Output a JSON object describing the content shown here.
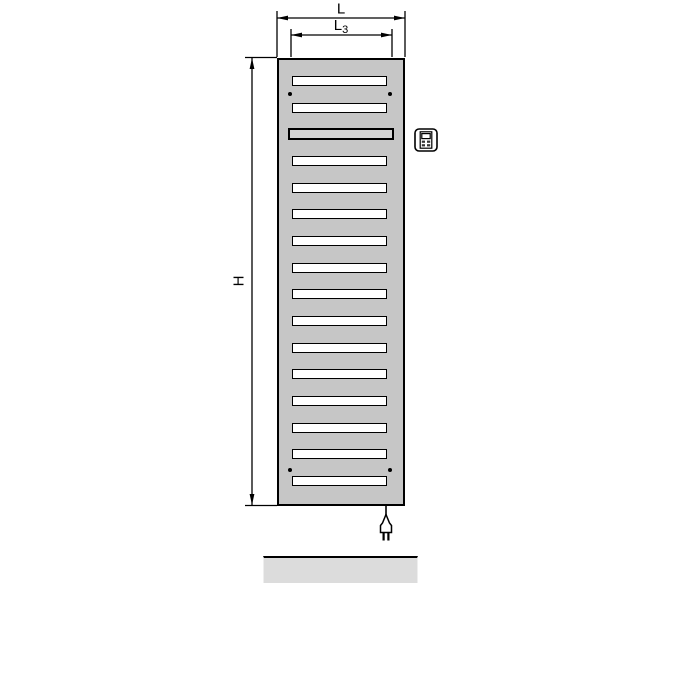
{
  "diagram": {
    "type": "radiator-dimension-drawing",
    "dimensions": {
      "width_label": "L",
      "inner_width_label_main": "L",
      "inner_width_label_sub": "3",
      "height_label": "H"
    },
    "radiator": {
      "slot_count": 16,
      "bar_slot_index": 2,
      "mounting_dot_pairs": 2
    },
    "icons": {
      "controller": "controller-icon",
      "plug": "power-plug-icon"
    },
    "colors": {
      "body": "#c6c6c6",
      "bar_slot": "#d5d5d5",
      "slot": "#ffffff",
      "floor": "#dcdcdc",
      "line": "#000000"
    }
  }
}
